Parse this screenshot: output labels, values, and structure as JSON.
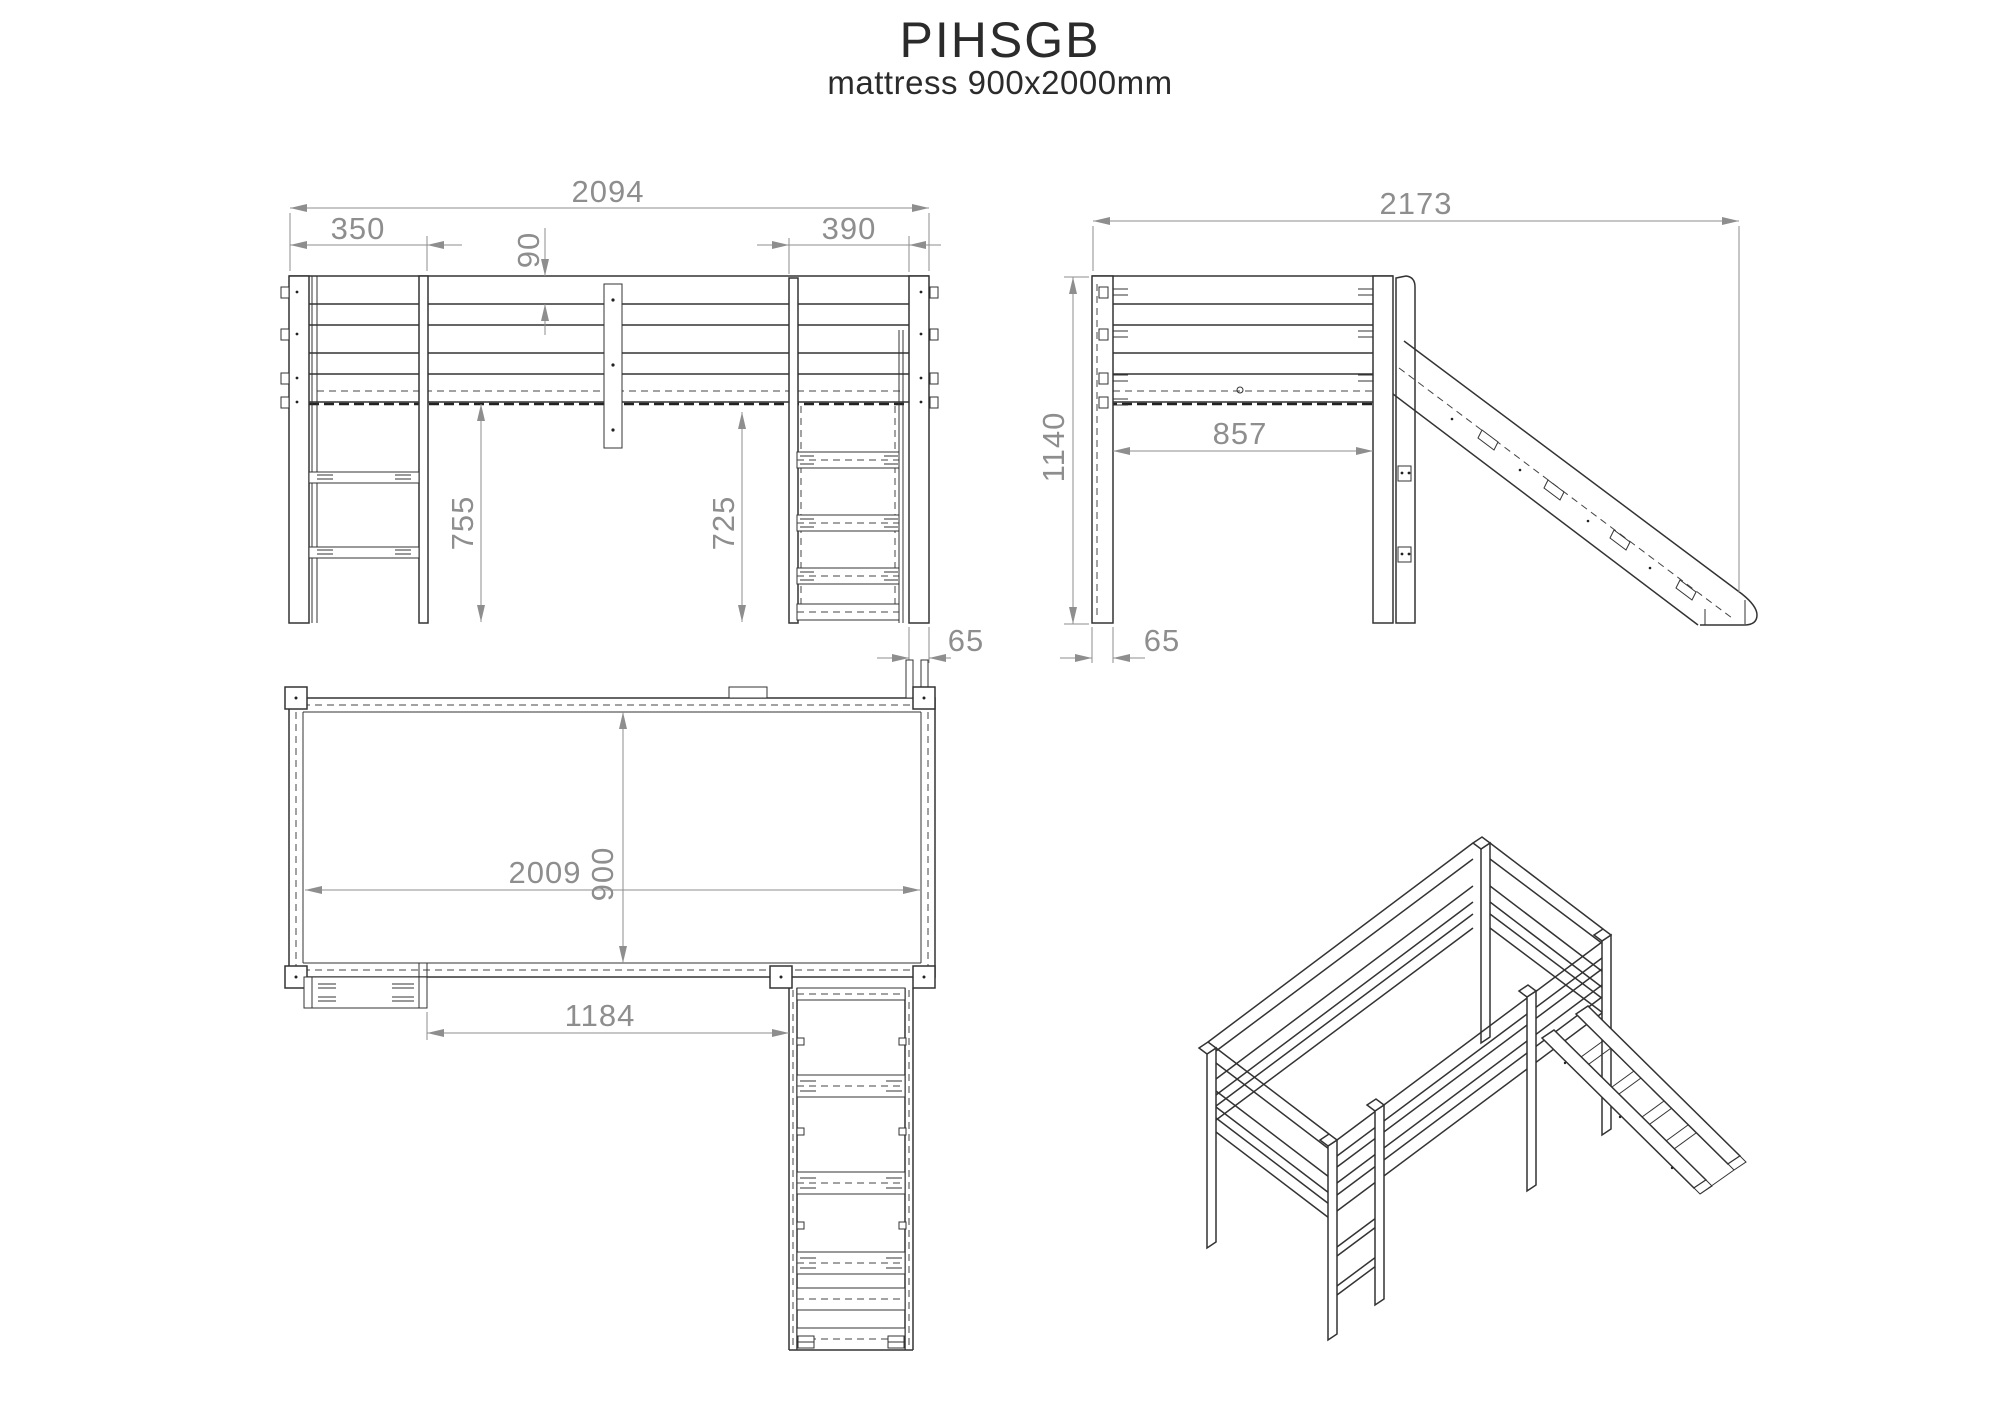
{
  "title": "PIHSGB",
  "subtitle": "mattress 900x2000mm",
  "views": {
    "front": {
      "label": "front elevation",
      "dims": {
        "total_width": "2094",
        "left_post_offset": "350",
        "rail_board_height": "90",
        "slide_section_width": "390",
        "clearance_left": "755",
        "clearance_right": "725",
        "post_depth": "65"
      }
    },
    "side": {
      "label": "side elevation with slide",
      "dims": {
        "total_depth": "2173",
        "total_height": "1140",
        "clear_span": "857",
        "post_width": "65"
      }
    },
    "top": {
      "label": "top plan",
      "dims": {
        "mattress_length": "2009",
        "mattress_width": "900",
        "front_opening": "1184"
      }
    },
    "isometric": {
      "label": "isometric overview"
    }
  },
  "colors": {
    "line": "#333333",
    "dimension": "#8e8e8e",
    "background": "#ffffff"
  }
}
